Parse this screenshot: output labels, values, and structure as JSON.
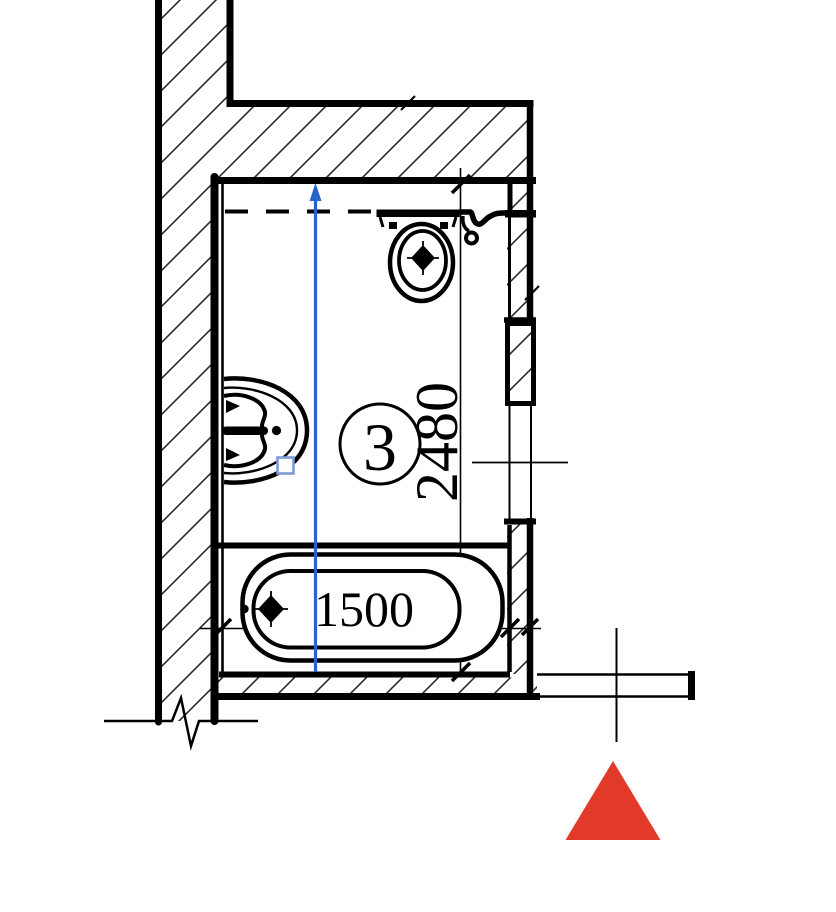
{
  "plan": {
    "room_label": "3",
    "dim_vertical": "2480",
    "dim_horizontal": "1500",
    "colors": {
      "ink": "#000000",
      "hatch": "#2b2b2b",
      "measure_blue": "#2465cb",
      "grip_blue": "#7e9bd3",
      "marker_red": "#e23a28"
    },
    "icons": {
      "toilet": "toilet-plan-icon",
      "sink": "sink-plan-icon",
      "bathtub": "bathtub-plan-icon",
      "arrow": "measure-arrow-up-icon",
      "marker": "red-triangle-marker-icon"
    }
  }
}
